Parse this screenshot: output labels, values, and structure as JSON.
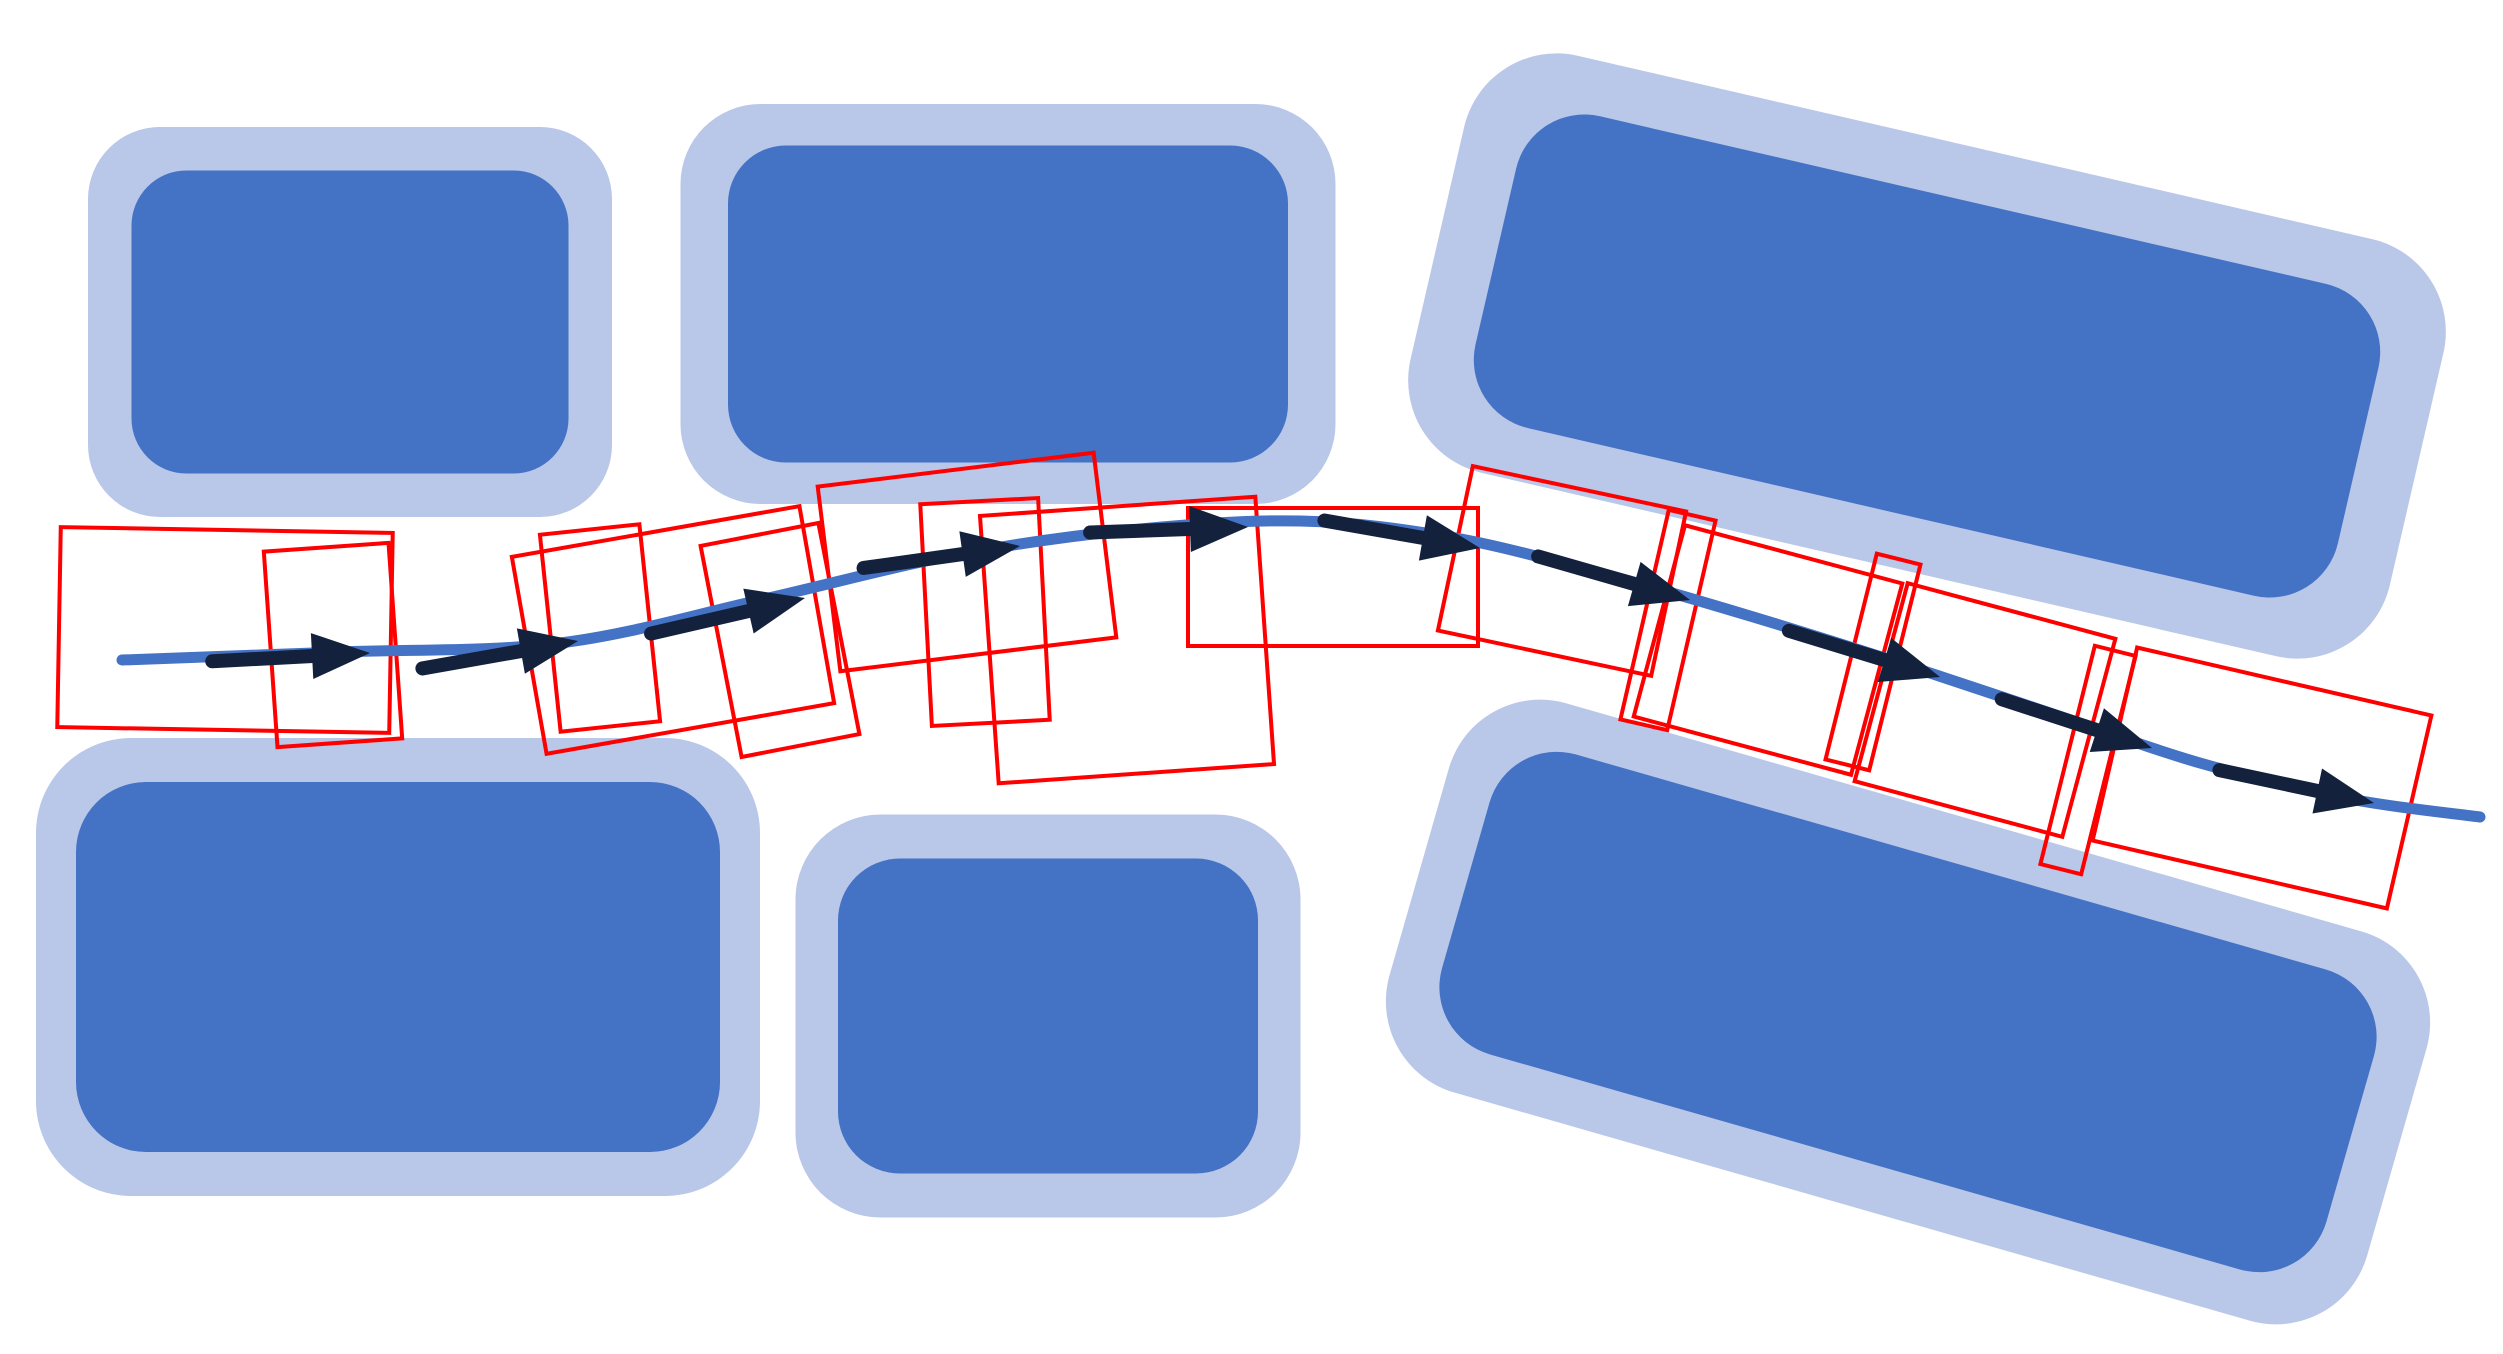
{
  "diagram": {
    "canvas": {
      "width": 2503,
      "height": 1354,
      "background": "#FFFFFF"
    },
    "colors": {
      "obstacle_fill": "#4472C4",
      "inflation_halo": "#B9C7E8",
      "trajectory": "#4472C4",
      "arrow": "#14213D",
      "corridor": "#FE0000"
    },
    "obstacles": [
      {
        "id": "top-left",
        "cx": 350,
        "cy": 322,
        "angle": 0,
        "halo": {
          "w": 524,
          "h": 390,
          "r": 72
        },
        "body": {
          "w": 437,
          "h": 303,
          "r": 55
        }
      },
      {
        "id": "top-middle",
        "cx": 1008,
        "cy": 304,
        "angle": 0,
        "halo": {
          "w": 655,
          "h": 400,
          "r": 80
        },
        "body": {
          "w": 560,
          "h": 317,
          "r": 58
        }
      },
      {
        "id": "top-right",
        "cx": 1927,
        "cy": 356,
        "angle": 13,
        "halo": {
          "w": 1005,
          "h": 428,
          "r": 95
        },
        "body": {
          "w": 885,
          "h": 320,
          "r": 70
        }
      },
      {
        "id": "bottom-left",
        "cx": 398,
        "cy": 967,
        "angle": 0,
        "halo": {
          "w": 724,
          "h": 458,
          "r": 95
        },
        "body": {
          "w": 644,
          "h": 370,
          "r": 70
        }
      },
      {
        "id": "bottom-middle",
        "cx": 1048,
        "cy": 1016,
        "angle": 0,
        "halo": {
          "w": 505,
          "h": 403,
          "r": 85
        },
        "body": {
          "w": 420,
          "h": 315,
          "r": 62
        }
      },
      {
        "id": "bottom-right",
        "cx": 1908,
        "cy": 1012,
        "angle": 16,
        "halo": {
          "w": 1017,
          "h": 405,
          "r": 95
        },
        "body": {
          "w": 920,
          "h": 312,
          "r": 70
        }
      }
    ],
    "corridor": {
      "stroke_width": 4,
      "boxes": [
        {
          "cx": 225,
          "cy": 630,
          "w": 332,
          "h": 200,
          "angle": 1
        },
        {
          "cx": 333,
          "cy": 645,
          "w": 125,
          "h": 196,
          "angle": -4
        },
        {
          "cx": 600,
          "cy": 628,
          "w": 100,
          "h": 198,
          "angle": -6
        },
        {
          "cx": 673,
          "cy": 630,
          "w": 292,
          "h": 200,
          "angle": -10
        },
        {
          "cx": 780,
          "cy": 640,
          "w": 120,
          "h": 215,
          "angle": -11
        },
        {
          "cx": 967,
          "cy": 562,
          "w": 278,
          "h": 186,
          "angle": -7
        },
        {
          "cx": 985,
          "cy": 612,
          "w": 118,
          "h": 222,
          "angle": -3
        },
        {
          "cx": 1127,
          "cy": 640,
          "w": 276,
          "h": 268,
          "angle": -4
        },
        {
          "cx": 1333,
          "cy": 577,
          "w": 290,
          "h": 138,
          "angle": 0
        },
        {
          "cx": 1562,
          "cy": 571,
          "w": 218,
          "h": 168,
          "angle": 12
        },
        {
          "cx": 1668,
          "cy": 620,
          "w": 48,
          "h": 215,
          "angle": 13
        },
        {
          "cx": 1768,
          "cy": 650,
          "w": 225,
          "h": 198,
          "angle": 15
        },
        {
          "cx": 1873,
          "cy": 662,
          "w": 45,
          "h": 212,
          "angle": 14
        },
        {
          "cx": 1985,
          "cy": 710,
          "w": 215,
          "h": 205,
          "angle": 15
        },
        {
          "cx": 2088,
          "cy": 760,
          "w": 42,
          "h": 225,
          "angle": 14
        },
        {
          "cx": 2262,
          "cy": 778,
          "w": 302,
          "h": 198,
          "angle": 13
        }
      ]
    },
    "trajectory": {
      "stroke_width": 11,
      "points": [
        [
          122,
          660
        ],
        [
          340,
          652
        ],
        [
          560,
          643
        ],
        [
          760,
          600
        ],
        [
          950,
          556
        ],
        [
          1130,
          530
        ],
        [
          1300,
          521
        ],
        [
          1450,
          537
        ],
        [
          1600,
          573
        ],
        [
          1750,
          616
        ],
        [
          1900,
          663
        ],
        [
          2050,
          713
        ],
        [
          2200,
          763
        ],
        [
          2350,
          799
        ],
        [
          2480,
          817
        ]
      ]
    },
    "arrows": {
      "style": {
        "shaft_length": 100,
        "shaft_width": 14,
        "head_length": 58,
        "head_half_width": 23
      },
      "markers": [
        {
          "x": 370,
          "y": 653,
          "angle": -3
        },
        {
          "x": 578,
          "y": 641,
          "angle": -10
        },
        {
          "x": 805,
          "y": 598,
          "angle": -13
        },
        {
          "x": 1020,
          "y": 546,
          "angle": -8
        },
        {
          "x": 1248,
          "y": 527,
          "angle": -2
        },
        {
          "x": 1480,
          "y": 548,
          "angle": 10
        },
        {
          "x": 1690,
          "y": 600,
          "angle": 16
        },
        {
          "x": 1940,
          "y": 677,
          "angle": 17
        },
        {
          "x": 2152,
          "y": 748,
          "angle": 18
        },
        {
          "x": 2374,
          "y": 803,
          "angle": 12
        }
      ]
    }
  }
}
